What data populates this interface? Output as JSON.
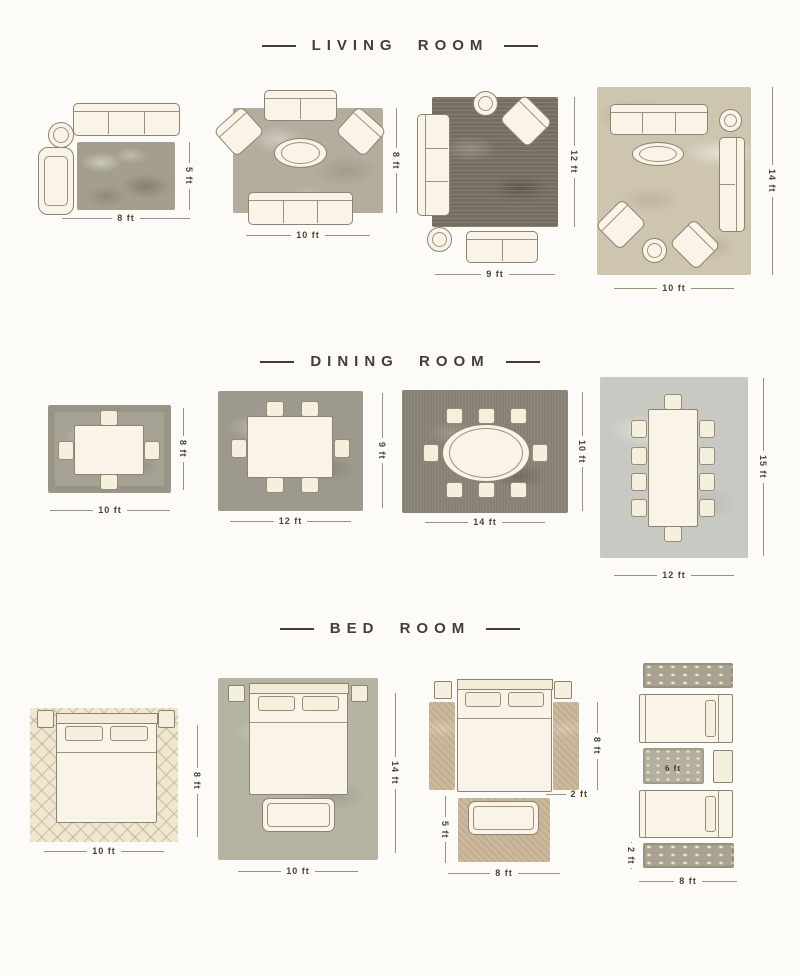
{
  "sections": {
    "living_room": {
      "title": "LIVING ROOM",
      "diagrams": [
        {
          "width": "8 ft",
          "height": "5 ft"
        },
        {
          "width": "10 ft",
          "height": "8 ft"
        },
        {
          "width": "9 ft",
          "height": "12 ft"
        },
        {
          "width": "10 ft",
          "height": "14 ft"
        }
      ]
    },
    "dining_room": {
      "title": "DINING ROOM",
      "diagrams": [
        {
          "width": "10 ft",
          "height": "8 ft"
        },
        {
          "width": "12 ft",
          "height": "9 ft"
        },
        {
          "width": "14 ft",
          "height": "10 ft"
        },
        {
          "width": "12 ft",
          "height": "15 ft"
        }
      ]
    },
    "bed_room": {
      "title": "BED ROOM",
      "diagrams": [
        {
          "width": "10 ft",
          "height": "8 ft"
        },
        {
          "width": "10 ft",
          "height": "14 ft"
        },
        {
          "runner_height": "8 ft",
          "runner_width": "2 ft",
          "foot_rug_height": "5 ft",
          "foot_rug_width": "8 ft"
        },
        {
          "center_rug_width": "6 ft",
          "runner_width": "2 ft",
          "width": "8 ft"
        }
      ]
    }
  },
  "colors": {
    "background": "#fcfbf7",
    "furniture_fill": "#f9f4e7",
    "outline": "#8d8370",
    "text": "#453e32"
  }
}
